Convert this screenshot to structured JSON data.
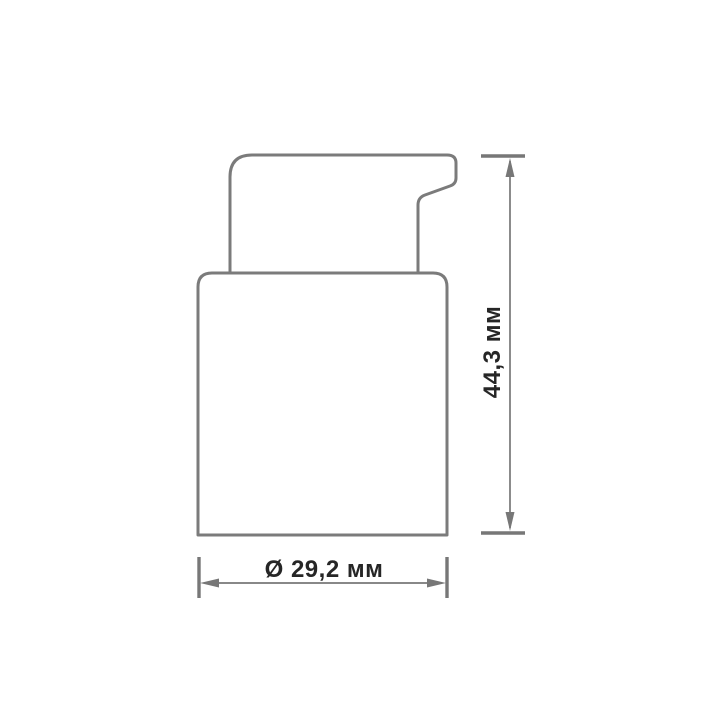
{
  "drawing": {
    "figure": "dispenser-pump-cap-side-view",
    "background_color": "#ffffff",
    "outline_color": "#7b7b7b",
    "dimension_line_color": "#777777",
    "text_color": "#262626",
    "dimensions": {
      "height": {
        "label": "44,3 мм"
      },
      "diameter": {
        "label": "Ø 29,2 мм"
      }
    }
  }
}
